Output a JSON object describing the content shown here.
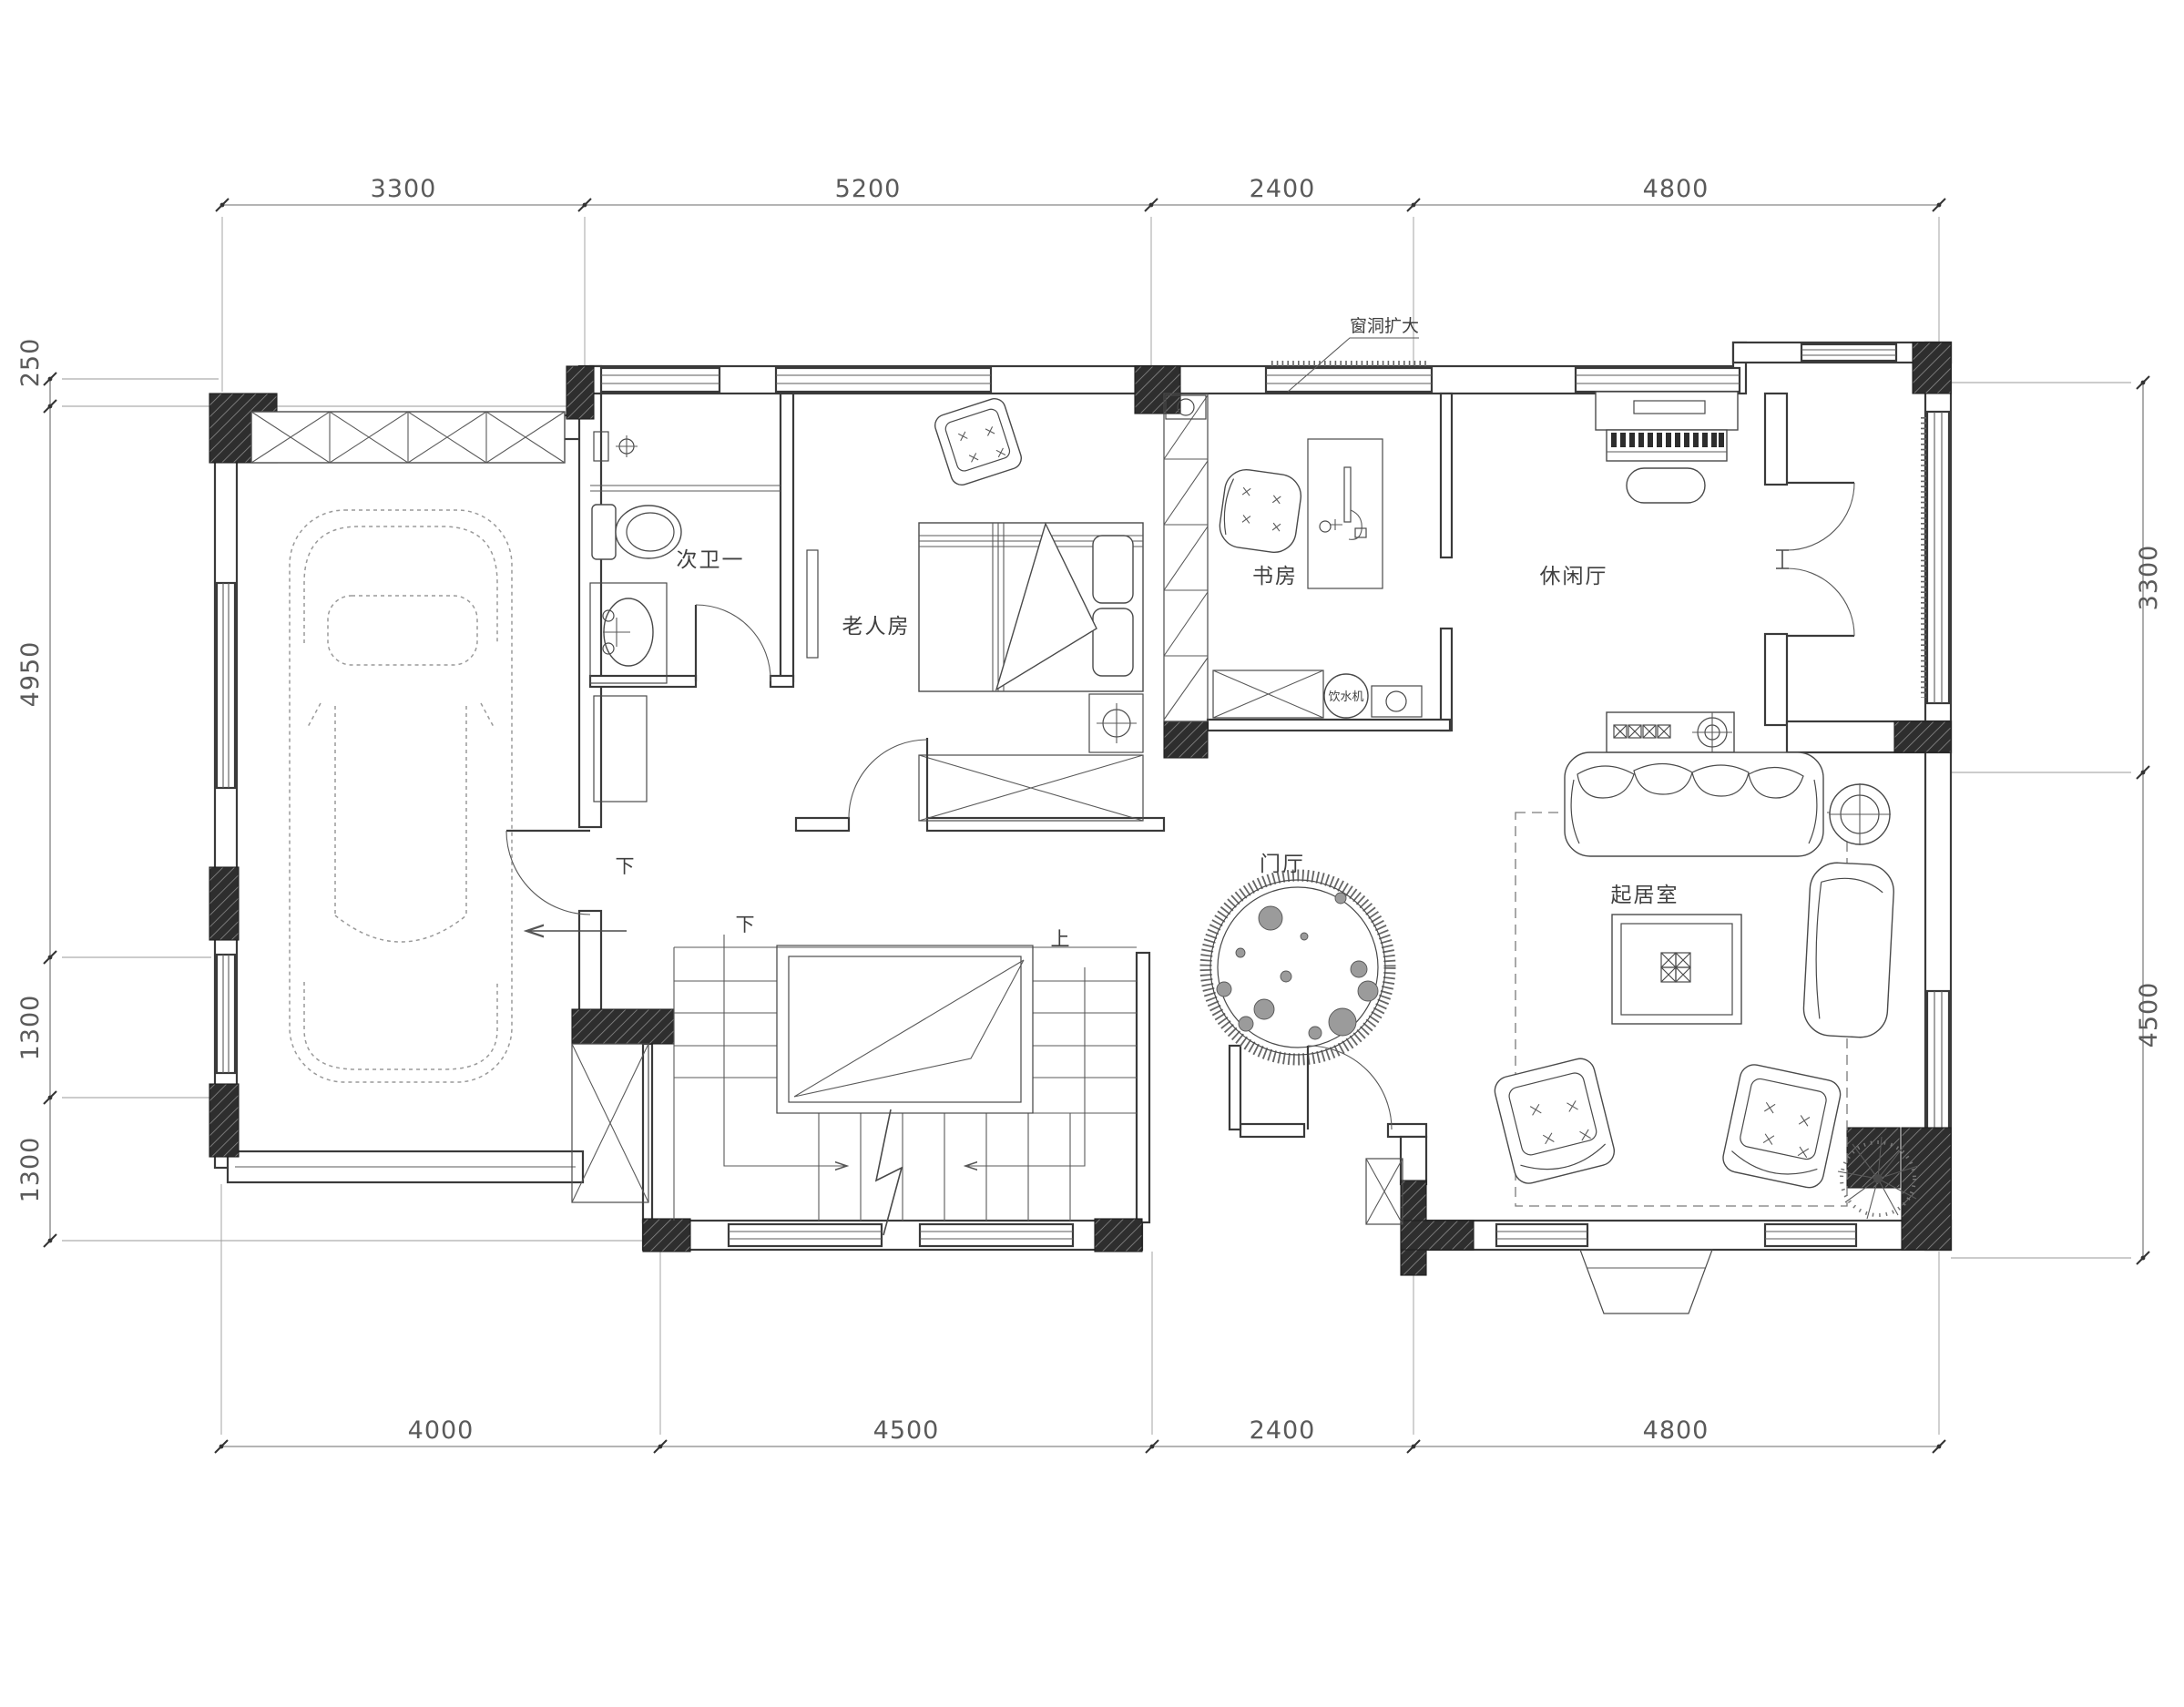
{
  "dimensions": {
    "top": [
      "3300",
      "5200",
      "2400",
      "4800"
    ],
    "bottom": [
      "4000",
      "4500",
      "2400",
      "4800"
    ],
    "left": [
      "250",
      "4950",
      "1300",
      "1300"
    ],
    "right": [
      "3300",
      "4500"
    ]
  },
  "rooms": {
    "bathroom": "次卫一",
    "elder_bedroom": "老人房",
    "study": "书房",
    "leisure_hall": "休闲厅",
    "foyer": "门厅",
    "living_room": "起居室"
  },
  "labels": {
    "window_note": "窗洞扩大",
    "water_dispenser": "饮水机",
    "down_garage": "下",
    "down_stairs": "下",
    "up_stairs": "上"
  },
  "colors": {
    "background": "#ffffff",
    "wall_line": "#3a3a3a",
    "dimension_line": "#6a6a6a",
    "column_fill": "#2e2e2e",
    "text": "#3f3f3f"
  }
}
